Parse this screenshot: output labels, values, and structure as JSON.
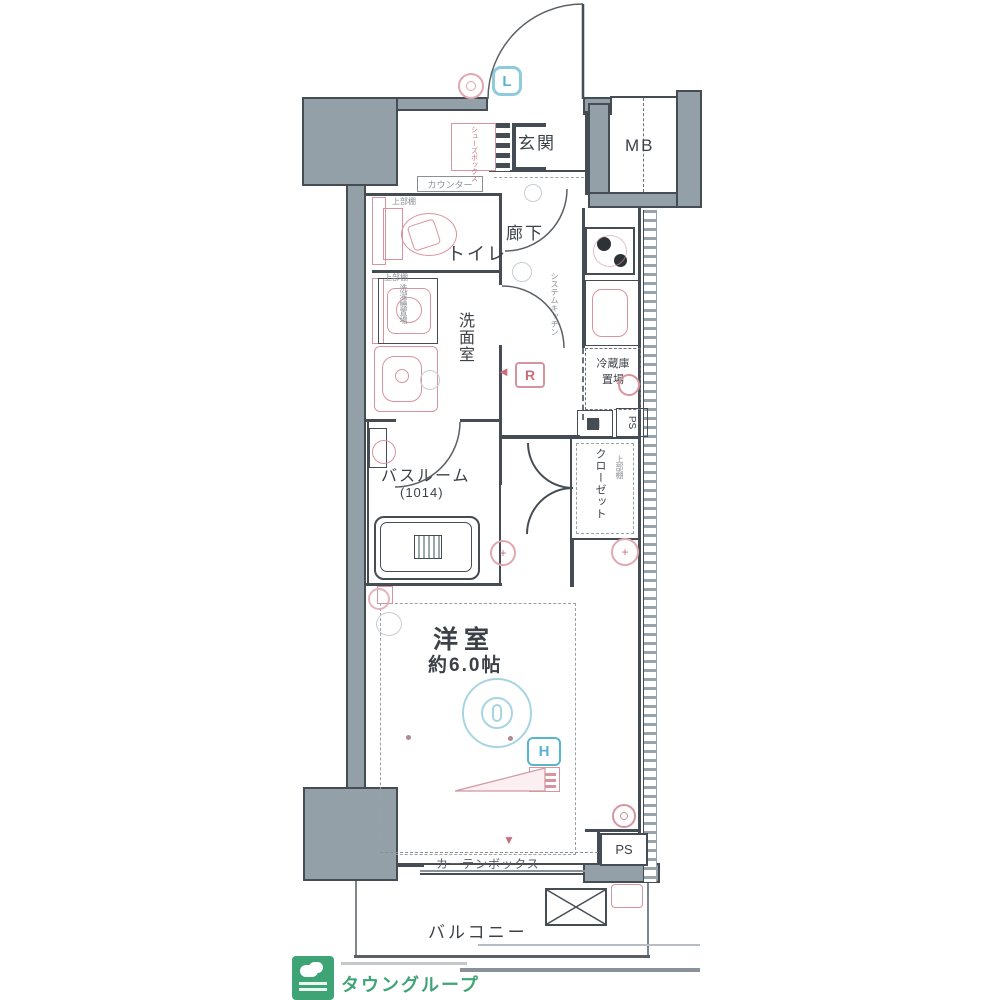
{
  "floorplan": {
    "rooms": {
      "genkan": "玄関",
      "mb": "MB",
      "toilet": "トイレ",
      "hallway": "廊下",
      "washroom": "洗面室",
      "bathroom": "バスルーム",
      "bathroom_size": "(1014)",
      "closet": "クローゼット",
      "room": "洋室",
      "room_size": "約6.0帖",
      "balcony": "バルコニー"
    },
    "fixtures": {
      "counter": "カウンター",
      "shoe_box": "シューズボックス",
      "upper_shelf_toilet": "上部棚",
      "upper_shelf_washer": "上部棚",
      "washer": "洗濯機置場",
      "system_kitchen": "システムキッチン",
      "fridge_line1": "冷蔵庫",
      "fridge_line2": "置場",
      "shelf": "棚",
      "ps_top": "PS",
      "ps_bottom": "PS",
      "closet_shelf": "上部棚",
      "curtain_box": "カーテンボックス",
      "curtain_marker": "▼"
    },
    "badges": {
      "light_l": "L",
      "remote_r": "R",
      "hatch_h": "H"
    }
  },
  "footer": {
    "logo_text": "タウングループ"
  },
  "colors": {
    "wall_gray": "#93a0a8",
    "outline_dark": "#454c53",
    "fixture_pink": "#d8949e",
    "symbol_cyan": "#58b4cf",
    "logo_green": "#3ea375"
  }
}
